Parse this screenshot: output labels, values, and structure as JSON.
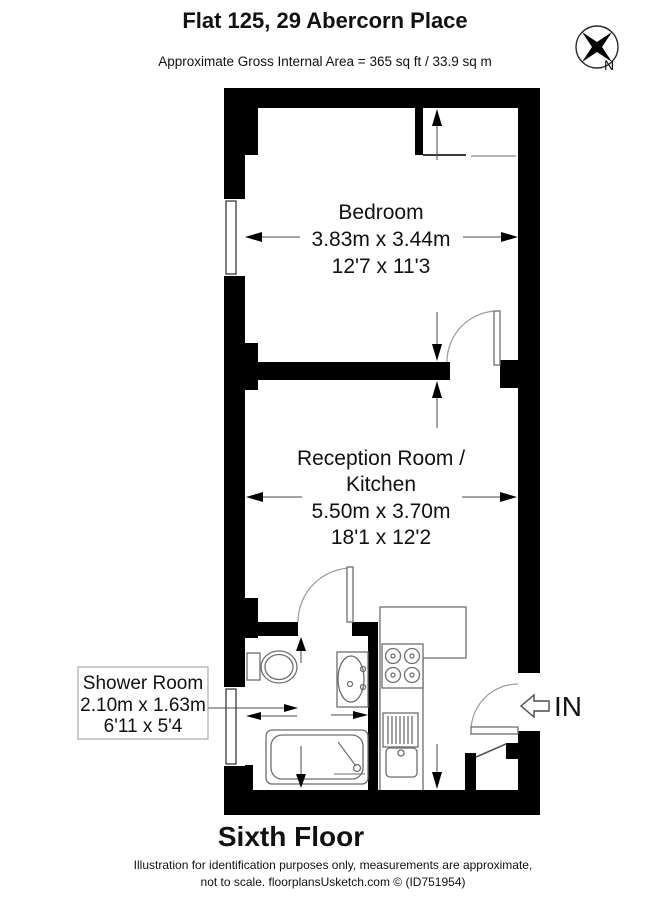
{
  "header": {
    "title": "Flat 125, 29 Abercorn Place",
    "subtitle": "Approximate Gross Internal Area = 365 sq ft / 33.9 sq m",
    "compass": "N"
  },
  "rooms": {
    "bedroom": {
      "name": "Bedroom",
      "size_metric": "3.83m x 3.44m",
      "size_imperial": "12'7 x 11'3"
    },
    "reception": {
      "name_line1": "Reception Room /",
      "name_line2": "Kitchen",
      "size_metric": "5.50m x 3.70m",
      "size_imperial": "18'1 x 12'2"
    },
    "shower_room": {
      "name": "Shower Room",
      "size_metric": "2.10m x 1.63m",
      "size_imperial": "6'11 x 5'4"
    }
  },
  "entrance": {
    "label": "IN"
  },
  "footer": {
    "floor": "Sixth Floor",
    "disclaimer_line1": "Illustration for identification purposes only, measurements are approximate,",
    "disclaimer_line2": "not to scale. floorplansUsketch.com © (ID751954)"
  },
  "colors": {
    "wall": "#000000",
    "fixture_line": "#6e6e6e",
    "text": "#111111",
    "background": "#ffffff"
  }
}
